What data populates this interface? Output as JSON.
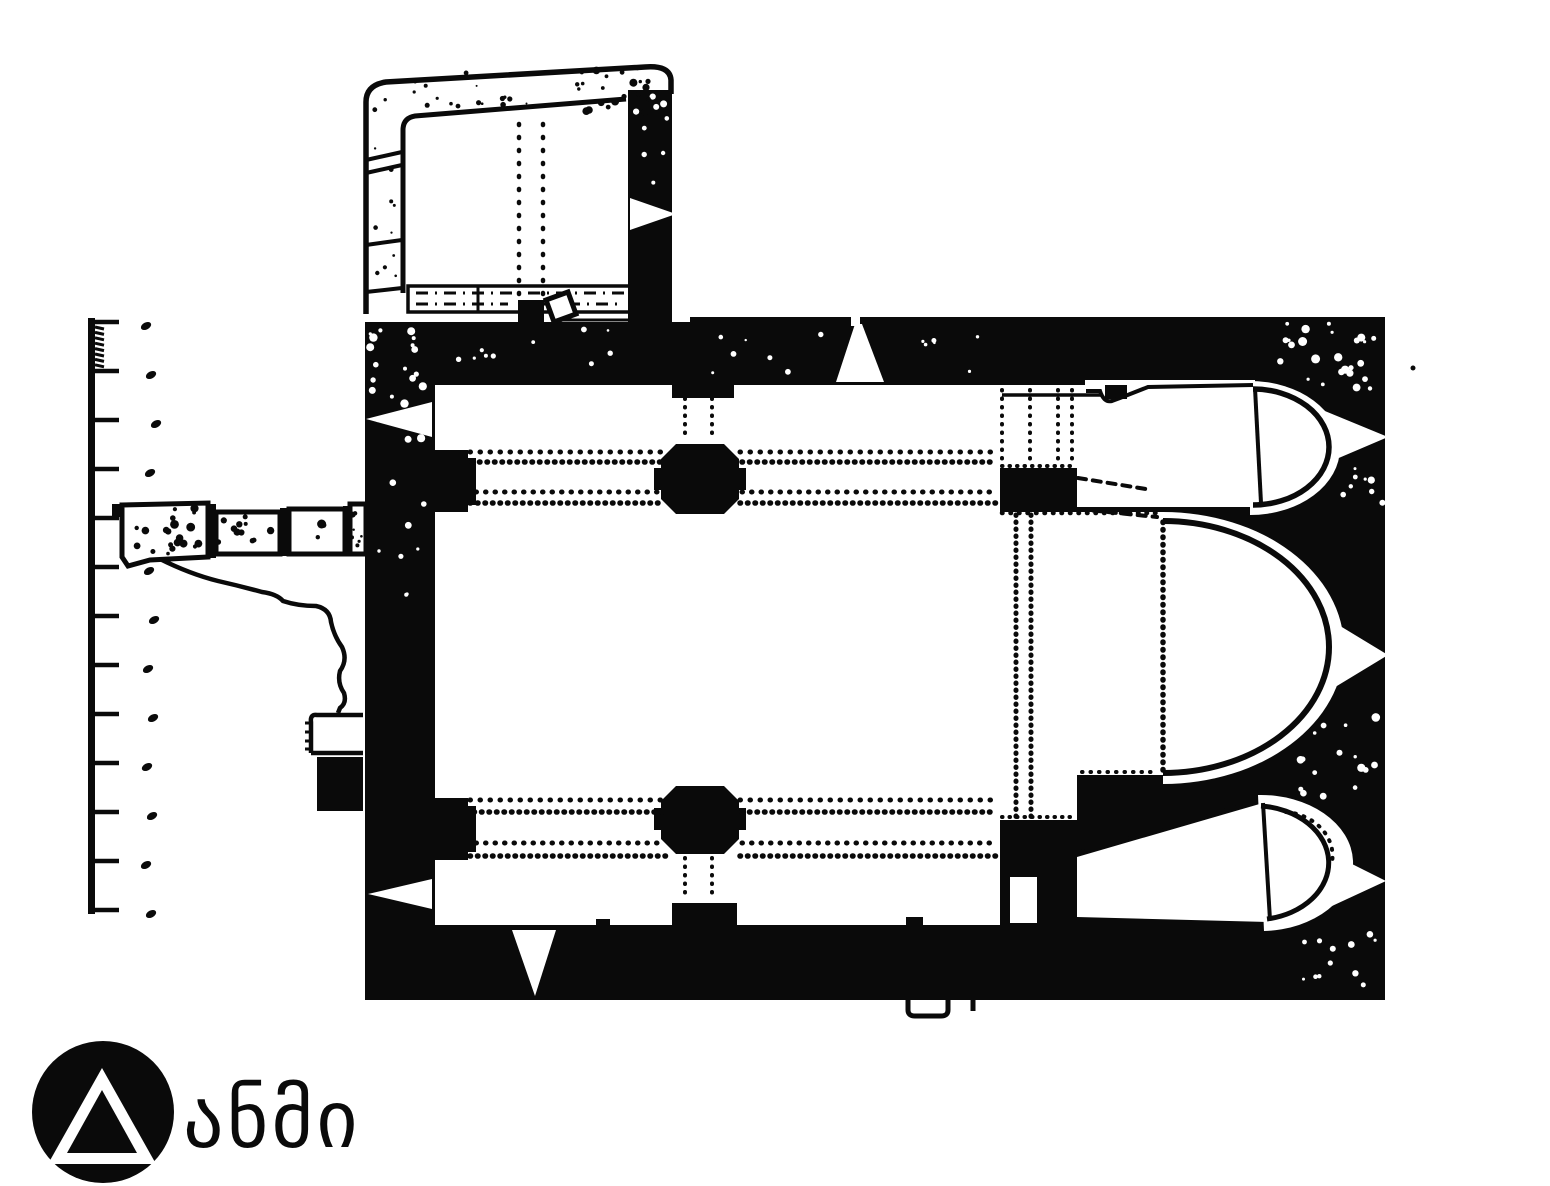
{
  "page": {
    "background_color": "#ffffff",
    "ink_color": "#0a0a0a"
  },
  "figure": {
    "kind": "scanned ink architectural floor plan",
    "subject": "single-nave church with three apses at the east end, north-west annexe room, two pairs of nave piers, west ruined wall stub with crack, splayed triangular windows, south and west doorways",
    "scale_bar": {
      "tick_count": 13,
      "subdivision_teeth": 8
    }
  },
  "logo": {
    "text": "ანმი",
    "mark": "triangle-in-circle",
    "color": "#0a0a0a"
  }
}
